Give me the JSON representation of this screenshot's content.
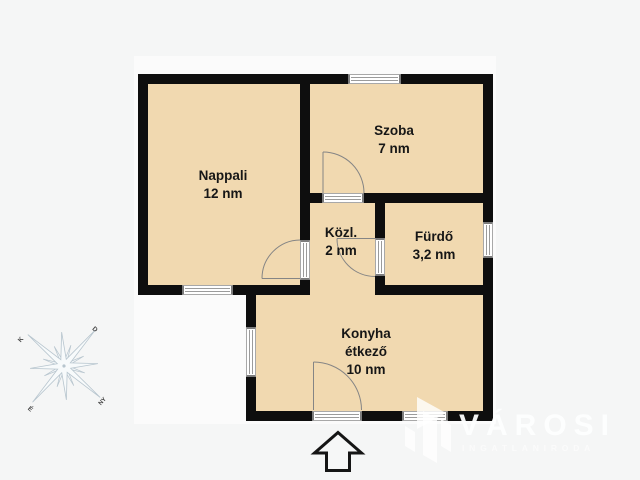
{
  "colors": {
    "page_background": "#f5f6f6",
    "plan_canvas": "#fbfbfb",
    "floor_fill": "#f1d9b0",
    "wall": "#0e0e0e",
    "opening_frame": "#7d7d7d",
    "door_arc": "#858585",
    "compass": "#b7c5ce",
    "label_text": "#161616",
    "watermark_text": "#fdfefe"
  },
  "floorplan": {
    "rooms": [
      {
        "id": "nappali",
        "lines": [
          "Nappali",
          "12 nm"
        ]
      },
      {
        "id": "szoba",
        "lines": [
          "Szoba",
          "7 nm"
        ]
      },
      {
        "id": "kozl",
        "lines": [
          "Közl.",
          "2 nm"
        ]
      },
      {
        "id": "furdo",
        "lines": [
          "Fürdő",
          "3,2 nm"
        ]
      },
      {
        "id": "konyha",
        "lines": [
          "Konyha",
          "étkező",
          "10 nm"
        ]
      }
    ],
    "areas_unit": "nm"
  },
  "compass": {
    "points": [
      {
        "pos": "top-left",
        "label": "K"
      },
      {
        "pos": "top-right",
        "label": "D"
      },
      {
        "pos": "bottom-left",
        "label": "É"
      },
      {
        "pos": "bottom-right",
        "label": "NY"
      }
    ]
  },
  "watermark": {
    "brand": "VÁROSI",
    "tagline": "INGATLANIRODA"
  }
}
